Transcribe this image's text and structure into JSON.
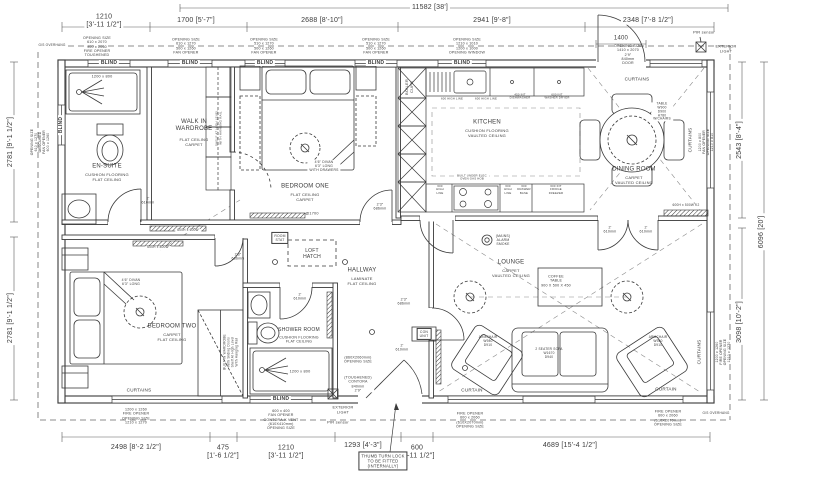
{
  "drawing": {
    "type": "bungalow floor plan",
    "ink_color": "#3a3a3a",
    "dim_color": "#4a4a4a",
    "background": "#ffffff"
  },
  "labels": {
    "dimensions_top": [
      {
        "name": "dim-overall-width",
        "text": "11582 [38']",
        "x": 430,
        "y": 8,
        "size": 7,
        "bg": true
      },
      {
        "name": "dim-ensuite-width",
        "text": "1210\n[3'-11 1/2\"]",
        "x": 104,
        "y": 22,
        "size": 7,
        "bg": true
      },
      {
        "name": "dim-wardrobe-width",
        "text": "1700 [5'-7\"]",
        "x": 196,
        "y": 21,
        "size": 7,
        "bg": true
      },
      {
        "name": "dim-bedroom-one-width",
        "text": "2688 [8'-10\"]",
        "x": 322,
        "y": 21,
        "size": 7,
        "bg": true
      },
      {
        "name": "dim-kitchen-width",
        "text": "2941 [9'-8\"]",
        "x": 492,
        "y": 21,
        "size": 7,
        "bg": true
      },
      {
        "name": "dim-dining-width",
        "text": "2348 [7'-8 1/2\"]",
        "x": 648,
        "y": 21,
        "size": 7,
        "bg": true
      },
      {
        "name": "dim-entrance-door",
        "text": "1400",
        "x": 621,
        "y": 39,
        "size": 6,
        "bg": true
      }
    ],
    "dimensions_bottom": [
      {
        "name": "dim-bedroom-two-width",
        "text": "2498 [8'-2 1/2\"]",
        "x": 136,
        "y": 448,
        "size": 7,
        "bg": true
      },
      {
        "name": "dim-wardrobe-recess",
        "text": "475\n[1'-6 1/2\"]",
        "x": 223,
        "y": 453,
        "size": 7,
        "bg": true
      },
      {
        "name": "dim-shower-room-width",
        "text": "1210\n[3'-11 1/2\"]",
        "x": 286,
        "y": 453,
        "size": 7,
        "bg": true
      },
      {
        "name": "dim-porch-width",
        "text": "1293 [4'-3\"]",
        "x": 363,
        "y": 446,
        "size": 7,
        "bg": true
      },
      {
        "name": "dim-front-door-width",
        "text": "600\n[1'-11 1/2\"]",
        "x": 417,
        "y": 453,
        "size": 7,
        "bg": true
      },
      {
        "name": "dim-lounge-width",
        "text": "4689 [15'-4 1/2\"]",
        "x": 570,
        "y": 446,
        "size": 7,
        "bg": true
      }
    ],
    "dimensions_left": [
      {
        "name": "dim-left-top",
        "text": "2781 [9'-1 1/2\"]",
        "x": 11,
        "y": 142,
        "size": 7,
        "rot": -90,
        "bg": true
      },
      {
        "name": "dim-left-bottom",
        "text": "2781 [9'-1 1/2\"]",
        "x": 11,
        "y": 318,
        "size": 7,
        "rot": -90,
        "bg": true
      }
    ],
    "dimensions_right": [
      {
        "name": "dim-dining-depth",
        "text": "2543 [8'-4\"]",
        "x": 740,
        "y": 140,
        "size": 7,
        "rot": -90,
        "bg": true
      },
      {
        "name": "dim-lounge-depth",
        "text": "3098 [10'-2\"]",
        "x": 740,
        "y": 322,
        "size": 7,
        "rot": -90,
        "bg": true
      },
      {
        "name": "dim-overall-depth",
        "text": "6096 [20']",
        "x": 762,
        "y": 232,
        "size": 7,
        "rot": -90,
        "bg": true
      }
    ],
    "window_treatments": [
      {
        "name": "blind-ensuite-top",
        "text": "BLIND",
        "x": 109,
        "y": 63,
        "size": 5,
        "bold": true,
        "bg": true
      },
      {
        "name": "blind-wardrobe",
        "text": "BLIND",
        "x": 190,
        "y": 63,
        "size": 5,
        "bold": true,
        "bg": true
      },
      {
        "name": "blind-bedroom-one-a",
        "text": "BLIND",
        "x": 265,
        "y": 63,
        "size": 5,
        "bold": true,
        "bg": true
      },
      {
        "name": "blind-bedroom-one-b",
        "text": "BLIND",
        "x": 376,
        "y": 63,
        "size": 5,
        "bold": true,
        "bg": true
      },
      {
        "name": "blind-kitchen",
        "text": "BLIND",
        "x": 462,
        "y": 63,
        "size": 5,
        "bold": true,
        "bg": true
      },
      {
        "name": "blind-ensuite-left",
        "text": "BLIND",
        "x": 61,
        "y": 125,
        "size": 5,
        "bold": true,
        "rot": -90,
        "bg": true
      },
      {
        "name": "blind-shower-room",
        "text": "BLIND",
        "x": 281,
        "y": 399,
        "size": 5,
        "bold": true,
        "bg": true
      },
      {
        "name": "curtains-entrance",
        "text": "CURTAINS",
        "x": 637,
        "y": 79,
        "size": 4.6
      },
      {
        "name": "curtains-dining-right",
        "text": "CURTAINS",
        "x": 690,
        "y": 140,
        "size": 4.6,
        "rot": -90
      },
      {
        "name": "curtains-bedroom-two",
        "text": "CURTAINS",
        "x": 139,
        "y": 390,
        "size": 4.6
      },
      {
        "name": "curtain-lounge-a",
        "text": "CURTAIN",
        "x": 472,
        "y": 390,
        "size": 4.6
      },
      {
        "name": "curtain-lounge-b",
        "text": "CURTAIN",
        "x": 666,
        "y": 389,
        "size": 4.6
      },
      {
        "name": "curtains-lounge-right",
        "text": "CURTAINS",
        "x": 699,
        "y": 352,
        "size": 4.6,
        "rot": -90
      }
    ],
    "opening_notes": [
      {
        "name": "opening-ensuite-top",
        "text": "OPENING SIZE\n610 x 2070\n900 x 2060\nFIRE OPENER\nTOUGHENED",
        "x": 97,
        "y": 47,
        "size": 3.6
      },
      {
        "name": "opening-wardrobe",
        "text": "OPENING SIZE\n610 x 1270\n500 x 1260\nFAN OPENER",
        "x": 186,
        "y": 46,
        "size": 3.6
      },
      {
        "name": "opening-bedroom-one-a",
        "text": "OPENING SIZE\n510 x 1270\n500 x 1260\nFAN OPENER",
        "x": 264,
        "y": 46,
        "size": 3.6
      },
      {
        "name": "opening-bedroom-one-b",
        "text": "OPENING SIZE\n510 x 1270\n500 x 1260\nFAN OPENER",
        "x": 376,
        "y": 46,
        "size": 3.6
      },
      {
        "name": "opening-kitchen-window",
        "text": "OPENING SIZE\n1210 x 1010\n1200 x 1000\nOPENING WINDOW",
        "x": 467,
        "y": 46,
        "size": 3.6
      },
      {
        "name": "opening-entrance-door",
        "text": "OPENING SIZE\n1410 x 2070\n2'9\"\n840mm\nDOOR",
        "x": 628,
        "y": 55,
        "size": 3.6
      },
      {
        "name": "opening-ensuite-left",
        "text": "OPENING SIZE\n610 x 1270\nOBSCURED\nFAN OPENER\n600 x 1260",
        "x": 40,
        "y": 142,
        "size": 3.4,
        "rot": -90
      },
      {
        "name": "opening-dining-right",
        "text": "1200 x 800\nFAN OPENER\nOPENING SIZE\n1210 x 810",
        "x": 706,
        "y": 142,
        "size": 3.4,
        "rot": -90
      },
      {
        "name": "opening-lounge-right",
        "text": "1200 x 1260\nFIRE OPENER\nOPENING SIZE\n1210 x 1270",
        "x": 723,
        "y": 352,
        "size": 3.4,
        "rot": -90
      },
      {
        "name": "opening-bedroom-two",
        "text": "1200 x 1260\nFIRE OPENER\nOPENING SIZE\n1210 x 1270",
        "x": 136,
        "y": 416,
        "size": 3.6
      },
      {
        "name": "opening-shower-vent",
        "text": "600 x 400\nFAN OPENER\nCONTORA-K VENT\n(610X410mm)\nOPENING SIZE",
        "x": 281,
        "y": 420,
        "size": 3.6
      },
      {
        "name": "opening-lounge-a",
        "text": "FIRE OPENER\n600 x 2060\n(610X2070mm)\nOPENING SIZE",
        "x": 470,
        "y": 420,
        "size": 3.6
      },
      {
        "name": "opening-lounge-b",
        "text": "FIRE OPENER\n600 x 2060\n(610X2070mm)\nOPENING SIZE",
        "x": 668,
        "y": 418,
        "size": 3.6
      },
      {
        "name": "front-door-spec",
        "text": "(TOUGHENED)\nCONTORA\n840mm\n2'9\"",
        "x": 358,
        "y": 384,
        "size": 3.6,
        "bg": true
      },
      {
        "name": "front-door-opening",
        "text": "(860X2060mm)\nOPENING SIZE",
        "x": 358,
        "y": 360,
        "size": 3.6,
        "bg": true
      }
    ],
    "rooms": [
      {
        "name": "room-ensuite",
        "text": "EN-SUITE",
        "x": 107,
        "y": 167,
        "size": 6
      },
      {
        "name": "room-ensuite-spec",
        "text": "CUSHION FLOORING\nFLAT CEILING",
        "x": 107,
        "y": 178,
        "size": 4
      },
      {
        "name": "room-wardrobe",
        "text": "WALK IN\nWARDROBE",
        "x": 194,
        "y": 126,
        "size": 6
      },
      {
        "name": "room-wardrobe-spec",
        "text": "FLAT CEILING\nCARPET",
        "x": 194,
        "y": 143,
        "size": 4
      },
      {
        "name": "room-bedroom-one",
        "text": "BEDROOM ONE",
        "x": 305,
        "y": 187,
        "size": 6
      },
      {
        "name": "room-bedroom-one-spec",
        "text": "FLAT CEILING\nCARPET",
        "x": 305,
        "y": 198,
        "size": 4
      },
      {
        "name": "room-kitchen",
        "text": "KITCHEN",
        "x": 487,
        "y": 123,
        "size": 6
      },
      {
        "name": "room-kitchen-spec",
        "text": "CUSHION FLOORING\nVAULTED CEILING",
        "x": 487,
        "y": 134,
        "size": 4
      },
      {
        "name": "room-dining",
        "text": "DINING ROOM",
        "x": 634,
        "y": 170,
        "size": 6
      },
      {
        "name": "room-dining-spec",
        "text": "CARPET\nVAULTED CEILING",
        "x": 634,
        "y": 181,
        "size": 4
      },
      {
        "name": "room-bedroom-two",
        "text": "BEDROOM TWO",
        "x": 172,
        "y": 327,
        "size": 6
      },
      {
        "name": "room-bedroom-two-spec",
        "text": "CARPET\nFLAT CEILING",
        "x": 172,
        "y": 338,
        "size": 4
      },
      {
        "name": "room-shower",
        "text": "SHOWER ROOM",
        "x": 299,
        "y": 330,
        "size": 5
      },
      {
        "name": "room-shower-spec",
        "text": "CUSHION FLOORING\nFLAT CEILING",
        "x": 299,
        "y": 340,
        "size": 3.6
      },
      {
        "name": "room-hallway",
        "text": "HALLWAY",
        "x": 362,
        "y": 271,
        "size": 6
      },
      {
        "name": "room-hallway-spec",
        "text": "LAMINATE\nFLAT CEILING",
        "x": 362,
        "y": 282,
        "size": 4
      },
      {
        "name": "room-lounge",
        "text": "LOUNGE",
        "x": 511,
        "y": 263,
        "size": 6
      },
      {
        "name": "room-lounge-spec",
        "text": "CARPET\nVAULTED CEILING",
        "x": 511,
        "y": 274,
        "size": 4
      },
      {
        "name": "loft-hatch",
        "text": "LOFT\nHATCH",
        "x": 312,
        "y": 254,
        "size": 5
      }
    ],
    "furniture": [
      {
        "name": "shower-size-ensuite",
        "text": "1200 x 800",
        "x": 102,
        "y": 77,
        "size": 3.8
      },
      {
        "name": "shower-size-shower-room",
        "text": "1200 x 800",
        "x": 300,
        "y": 372,
        "size": 3.8
      },
      {
        "name": "bed-one-spec",
        "text": "4'6\" DIVAN\n6'3\" LONG\nWITH DRAWERS",
        "x": 324,
        "y": 166,
        "size": 3.4,
        "bg": true
      },
      {
        "name": "bed-two-spec",
        "text": "4'6\" DIVAN\n6'3\" LONG",
        "x": 131,
        "y": 282,
        "size": 3.4,
        "bg": true
      },
      {
        "name": "coffee-table-spec",
        "text": "COFFEE\nTABLE\n900 X 500 X 450",
        "x": 556,
        "y": 281,
        "size": 3.6
      },
      {
        "name": "armchair-left-spec",
        "text": "ARMCHAIR\nW980\nD910",
        "x": 488,
        "y": 342,
        "size": 3.2
      },
      {
        "name": "armchair-right-spec",
        "text": "ARMCHAIR\nW980\nD910",
        "x": 658,
        "y": 342,
        "size": 3.2
      },
      {
        "name": "sofa-spec",
        "text": "2 SEATER SOFA\nW1670\nD940",
        "x": 549,
        "y": 354,
        "size": 3.2
      },
      {
        "name": "dining-table-spec",
        "text": "TABLE\nW900\nD900\nH780\nW/CHAIRS",
        "x": 662,
        "y": 112,
        "size": 3.2,
        "bg": true
      }
    ],
    "fixtures": [
      {
        "name": "pir-sensor-top",
        "text": "PIR sensor",
        "x": 704,
        "y": 33,
        "size": 4
      },
      {
        "name": "exterior-light-top",
        "text": "EXTERIOR\nLIGHT",
        "x": 726,
        "y": 49,
        "size": 3.8
      },
      {
        "name": "exterior-light-bottom",
        "text": "EXTERIOR\nLIGHT",
        "x": 343,
        "y": 410,
        "size": 3.8
      },
      {
        "name": "pir-sensor-bottom",
        "text": "PIR sensor",
        "x": 338,
        "y": 423,
        "size": 4
      },
      {
        "name": "smoke-alarm",
        "text": "(MAINS)\nALARM\nSMOKE",
        "x": 503,
        "y": 240,
        "size": 3.4
      },
      {
        "name": "room-stat",
        "text": "ROOM\nSTAT",
        "x": 280,
        "y": 238,
        "size": 3.4,
        "box": true
      },
      {
        "name": "consumer-unit",
        "text": "CON\nUNIT",
        "x": 424,
        "y": 334,
        "size": 3.4,
        "box": true
      },
      {
        "name": "bed-one-light-height",
        "text": "@1700",
        "x": 312,
        "y": 214,
        "size": 3.8
      },
      {
        "name": "radiator-dining",
        "text": "600H x 500W K2",
        "x": 686,
        "y": 206,
        "size": 3.2,
        "bg": true
      },
      {
        "name": "radiator-hall",
        "text": "600H x 600W",
        "x": 188,
        "y": 231,
        "size": 3.2,
        "bg": true
      },
      {
        "name": "radiator-bedroom-two",
        "text": "600H x 800W",
        "x": 158,
        "y": 248,
        "size": 3.2,
        "bg": true
      },
      {
        "name": "overhang-note-top",
        "text": "G/S OVERHANG",
        "x": 52,
        "y": 46,
        "size": 3.2,
        "bg": true
      },
      {
        "name": "overhang-note-bottom",
        "text": "G/S OVERHANG",
        "x": 716,
        "y": 414,
        "size": 3.2,
        "bg": true
      },
      {
        "name": "boiler-cupboard",
        "text": "BOILER\nCUPB",
        "x": 410,
        "y": 87,
        "size": 4,
        "rot": -90
      },
      {
        "name": "thumb-turn-note",
        "text": "THUMB TURN LOCK\nTO BE FITTED\n(INTERNALLY)",
        "x": 383,
        "y": 461,
        "size": 4.2,
        "box": true
      }
    ],
    "door_sizes": [
      {
        "name": "door-ensuite",
        "text": "2'\n610mm",
        "x": 148,
        "y": 201,
        "size": 3.6
      },
      {
        "name": "door-bedroom-one",
        "text": "2'3\"\n686mm",
        "x": 380,
        "y": 207,
        "size": 3.6
      },
      {
        "name": "door-bedroom-two",
        "text": "2'3\"\n686mm",
        "x": 238,
        "y": 257,
        "size": 3.6
      },
      {
        "name": "door-shower-room",
        "text": "2'\n610mm",
        "x": 300,
        "y": 297,
        "size": 3.6
      },
      {
        "name": "door-lounge",
        "text": "2'3\"\n686mm",
        "x": 404,
        "y": 302,
        "size": 3.6
      },
      {
        "name": "door-front",
        "text": "2'\n610mm",
        "x": 402,
        "y": 348,
        "size": 3.6
      },
      {
        "name": "door-dining-left",
        "text": "2'\n610mm",
        "x": 610,
        "y": 230,
        "size": 3.6
      },
      {
        "name": "door-dining-right",
        "text": "2'\n610mm",
        "x": 646,
        "y": 230,
        "size": 3.6
      }
    ],
    "wardrobe_notes": [
      {
        "name": "built-in-wardrobe-note",
        "text": "BUILT IN WARDROBE\nWith Sliding Doors\nShelf At High Level\nWith Hanging Rail",
        "x": 231,
        "y": 352,
        "size": 3.2,
        "rot": -90
      },
      {
        "name": "walk-in-wardrobe-note",
        "text": "SHELF AT HIGH LEVEL\nWITH HANGING RAIL",
        "x": 219,
        "y": 128,
        "size": 3,
        "rot": -90
      }
    ],
    "kitchen_units": [
      {
        "name": "unit-highline-a",
        "text": "600 HIGH LINE",
        "x": 452,
        "y": 99,
        "size": 2.8
      },
      {
        "name": "unit-highline-b",
        "text": "600 HIGH LINE",
        "x": 486,
        "y": 99,
        "size": 2.8
      },
      {
        "name": "unit-dishwasher",
        "text": "450 INT\nDISHWASHER",
        "x": 520,
        "y": 97,
        "size": 2.8
      },
      {
        "name": "unit-washer-dryer",
        "text": "600 INT\nWASHER DRYER",
        "x": 557,
        "y": 97,
        "size": 2.8
      },
      {
        "name": "unit-oven-hob",
        "text": "BUILT UNDER ELEC\nOVEN GAS HOB",
        "x": 472,
        "y": 178,
        "size": 2.8,
        "bg": true
      },
      {
        "name": "unit-highline-c",
        "text": "600\nHIGH\nLINE",
        "x": 440,
        "y": 190,
        "size": 2.8
      },
      {
        "name": "unit-highline-d",
        "text": "600\nHIGH\nLINE",
        "x": 508,
        "y": 190,
        "size": 2.8
      },
      {
        "name": "unit-drawer-base",
        "text": "600\nDRAWER\nBASE",
        "x": 524,
        "y": 190,
        "size": 2.8
      },
      {
        "name": "unit-fridge-freezer",
        "text": "600 INT\nFRIDGE\nFREEZER",
        "x": 556,
        "y": 190,
        "size": 2.8
      }
    ]
  }
}
